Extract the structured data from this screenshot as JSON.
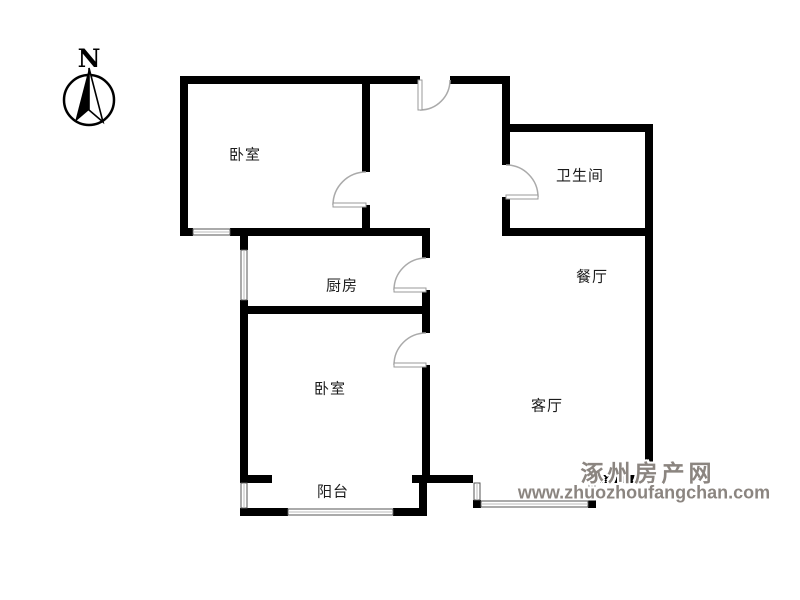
{
  "compass": {
    "label": "N"
  },
  "rooms": [
    {
      "id": "bedroom-top",
      "label": "卧室"
    },
    {
      "id": "bathroom",
      "label": "卫生间"
    },
    {
      "id": "kitchen",
      "label": "厨房"
    },
    {
      "id": "dining-room",
      "label": "餐厅"
    },
    {
      "id": "bedroom-bottom",
      "label": "卧室"
    },
    {
      "id": "living-room",
      "label": "客厅"
    },
    {
      "id": "balcony",
      "label": "阳台"
    }
  ],
  "watermark": {
    "site_name": "涿州房产网",
    "site_url": "www.zhuozhoufangchan.com"
  },
  "colors": {
    "wall": "#000000",
    "door_arc": "#aaaaaa",
    "window_line": "#555555",
    "label_text": "#1c1c1c",
    "watermark_gray": "#8b8580",
    "background": "#ffffff"
  }
}
